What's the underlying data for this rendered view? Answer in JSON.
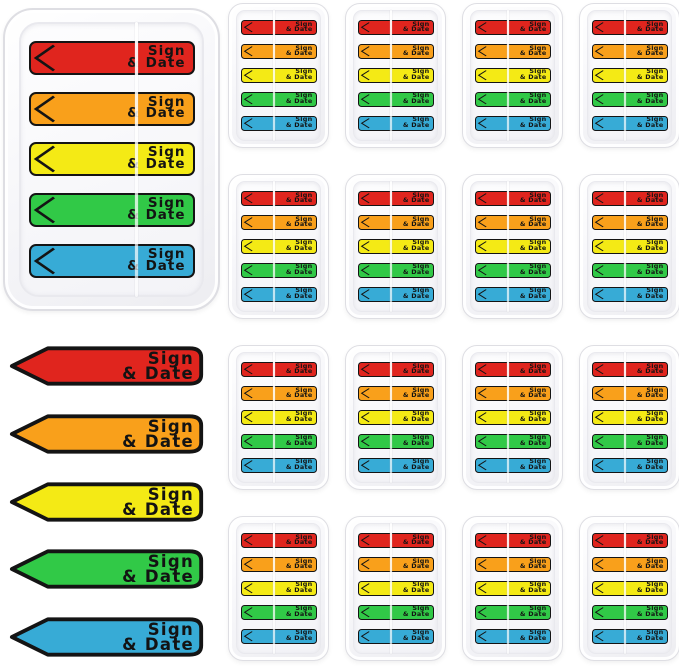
{
  "product": {
    "flag_label": {
      "line1": "Sign",
      "line2": "& Date"
    },
    "flag_colors": [
      {
        "name": "red",
        "hex": "#E0251E"
      },
      {
        "name": "orange",
        "hex": "#F9A01B"
      },
      {
        "name": "yellow",
        "hex": "#F4EA15"
      },
      {
        "name": "green",
        "hex": "#31C947"
      },
      {
        "name": "blue",
        "hex": "#37ABD6"
      }
    ],
    "outline_color": "#141414",
    "flags_per_dispenser": 5,
    "large_dispenser_count": 1,
    "small_dispenser_count": 16,
    "loose_flag_count": 5
  }
}
